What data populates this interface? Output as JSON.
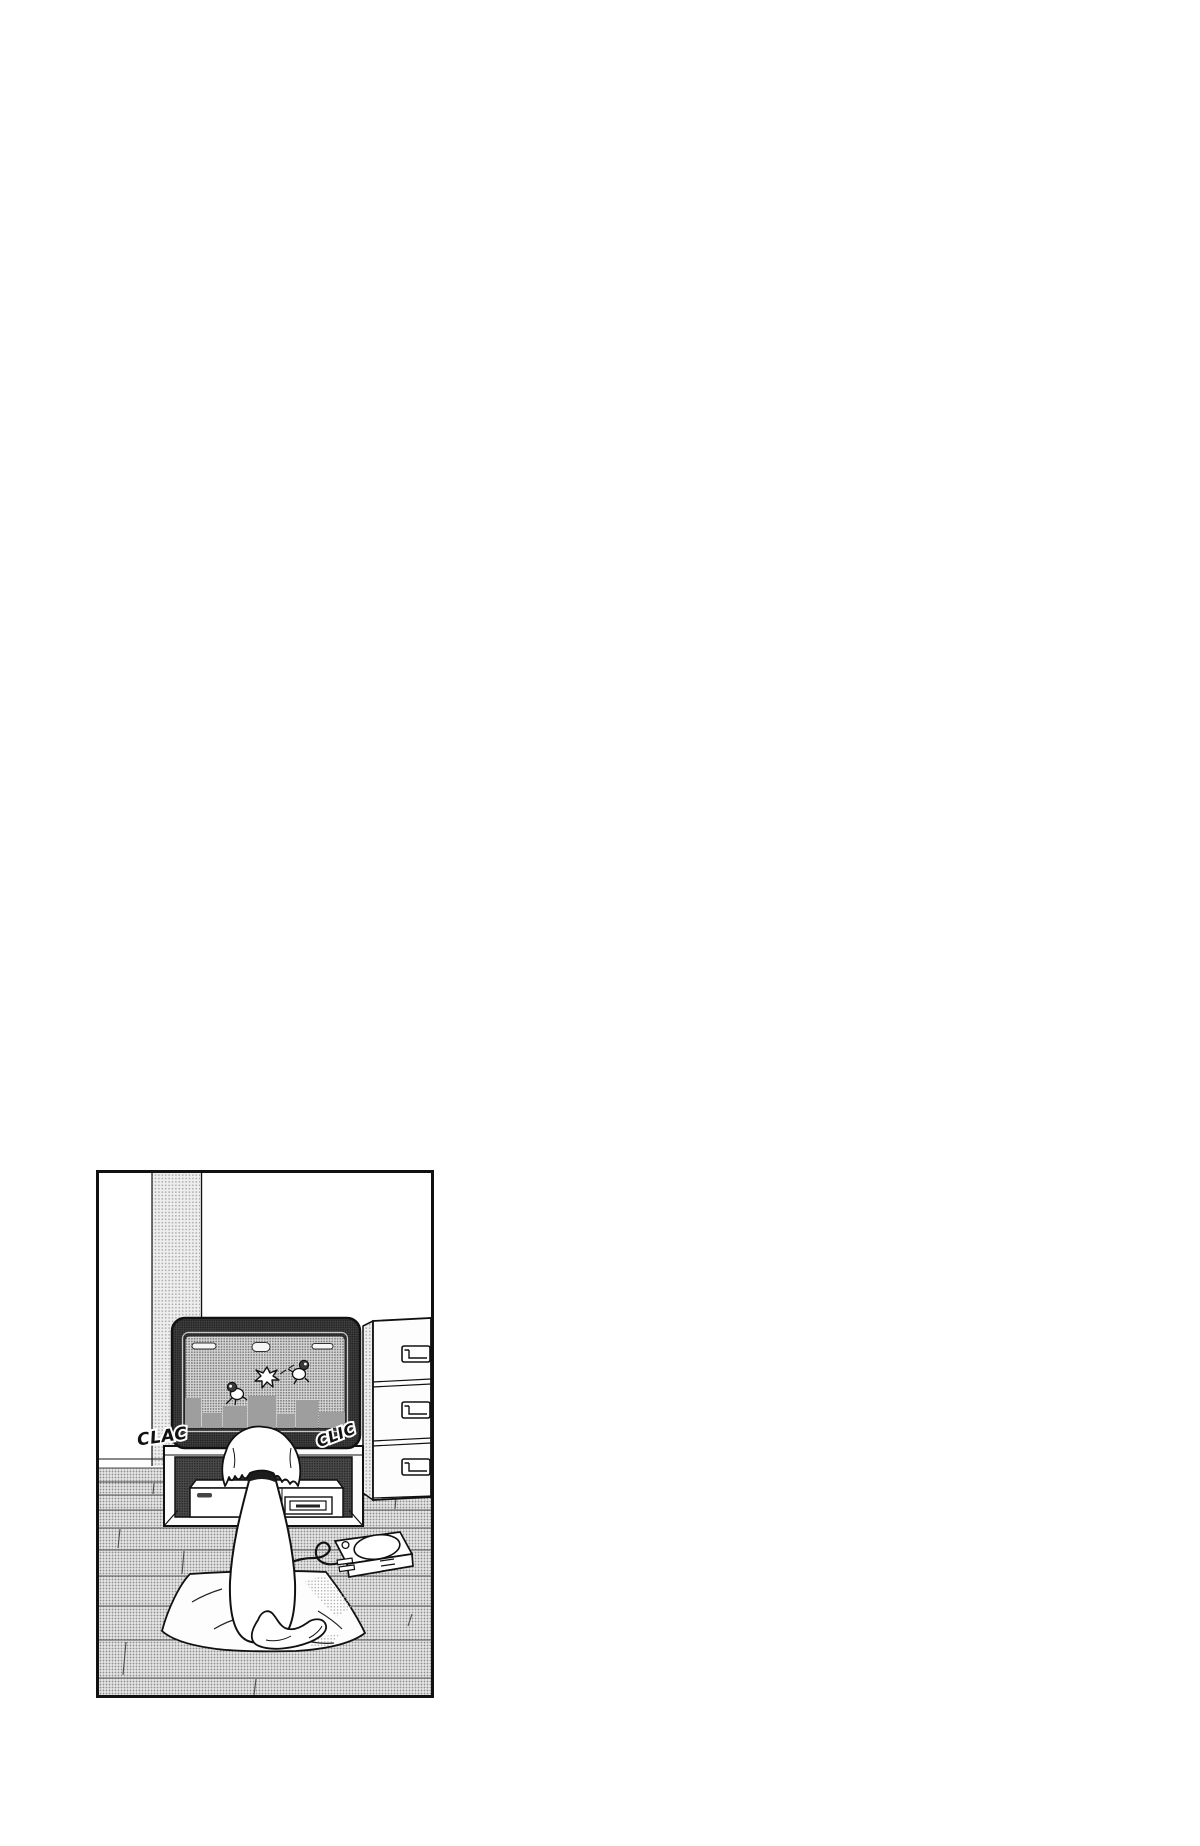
{
  "page": {
    "background": "#ffffff"
  },
  "panel": {
    "sfx": {
      "left": "CLAC",
      "right": "CLIC"
    },
    "colors": {
      "ink": "#111111",
      "paper": "#ffffff",
      "tv_frame_base": "#3f3f3f",
      "tv_frame_dot": "#1e1e1e",
      "screen_base": "#d8d8d8",
      "screen_dot": "#7a7a7a",
      "wall_base": "#eeeeee",
      "wall_dot": "#a8a8a8",
      "floor_base": "#e8e8e8",
      "floor_dot": "#909090",
      "shelf_base": "#4a4a4a",
      "shelf_dot": "#262626",
      "skyline": "#9e9e9e",
      "shade_dot": "#aeaeae"
    }
  }
}
